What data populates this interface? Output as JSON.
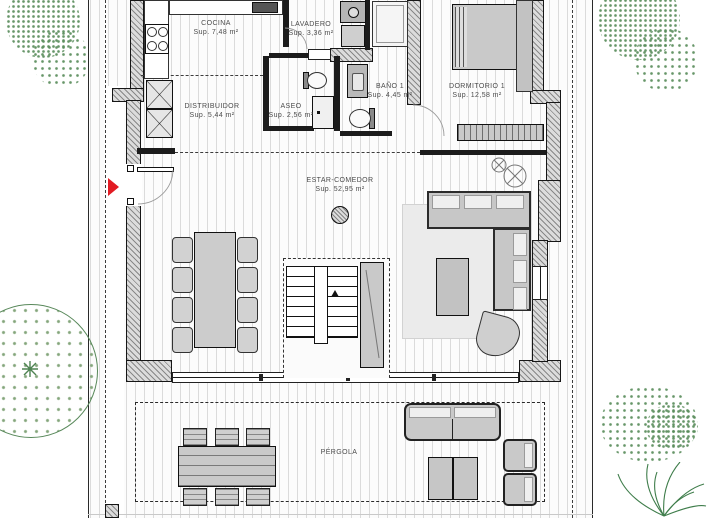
{
  "plan": {
    "rooms": [
      {
        "name": "COCINA",
        "area": "Sup. 7,48 m²"
      },
      {
        "name": "LAVADERO",
        "area": "Sup. 3,36 m²"
      },
      {
        "name": "DISTRIBUIDOR",
        "area": "Sup. 5,44 m²"
      },
      {
        "name": "ASEO",
        "area": "Sup. 2,56 m²"
      },
      {
        "name": "BAÑO 1",
        "area": "Sup. 4,45 m²"
      },
      {
        "name": "DORMITORIO 1",
        "area": "Sup. 12,58 m²"
      },
      {
        "name": "ESTAR-COMEDOR",
        "area": "Sup. 52,95 m²"
      },
      {
        "name": "PÉRGOLA",
        "area": ""
      }
    ],
    "colors": {
      "entrance_marker": "#e21b23",
      "foliage": "#5a8c5e",
      "wall_fill": "#dcdcdc",
      "furniture_fill": "#cbcbcb"
    }
  }
}
